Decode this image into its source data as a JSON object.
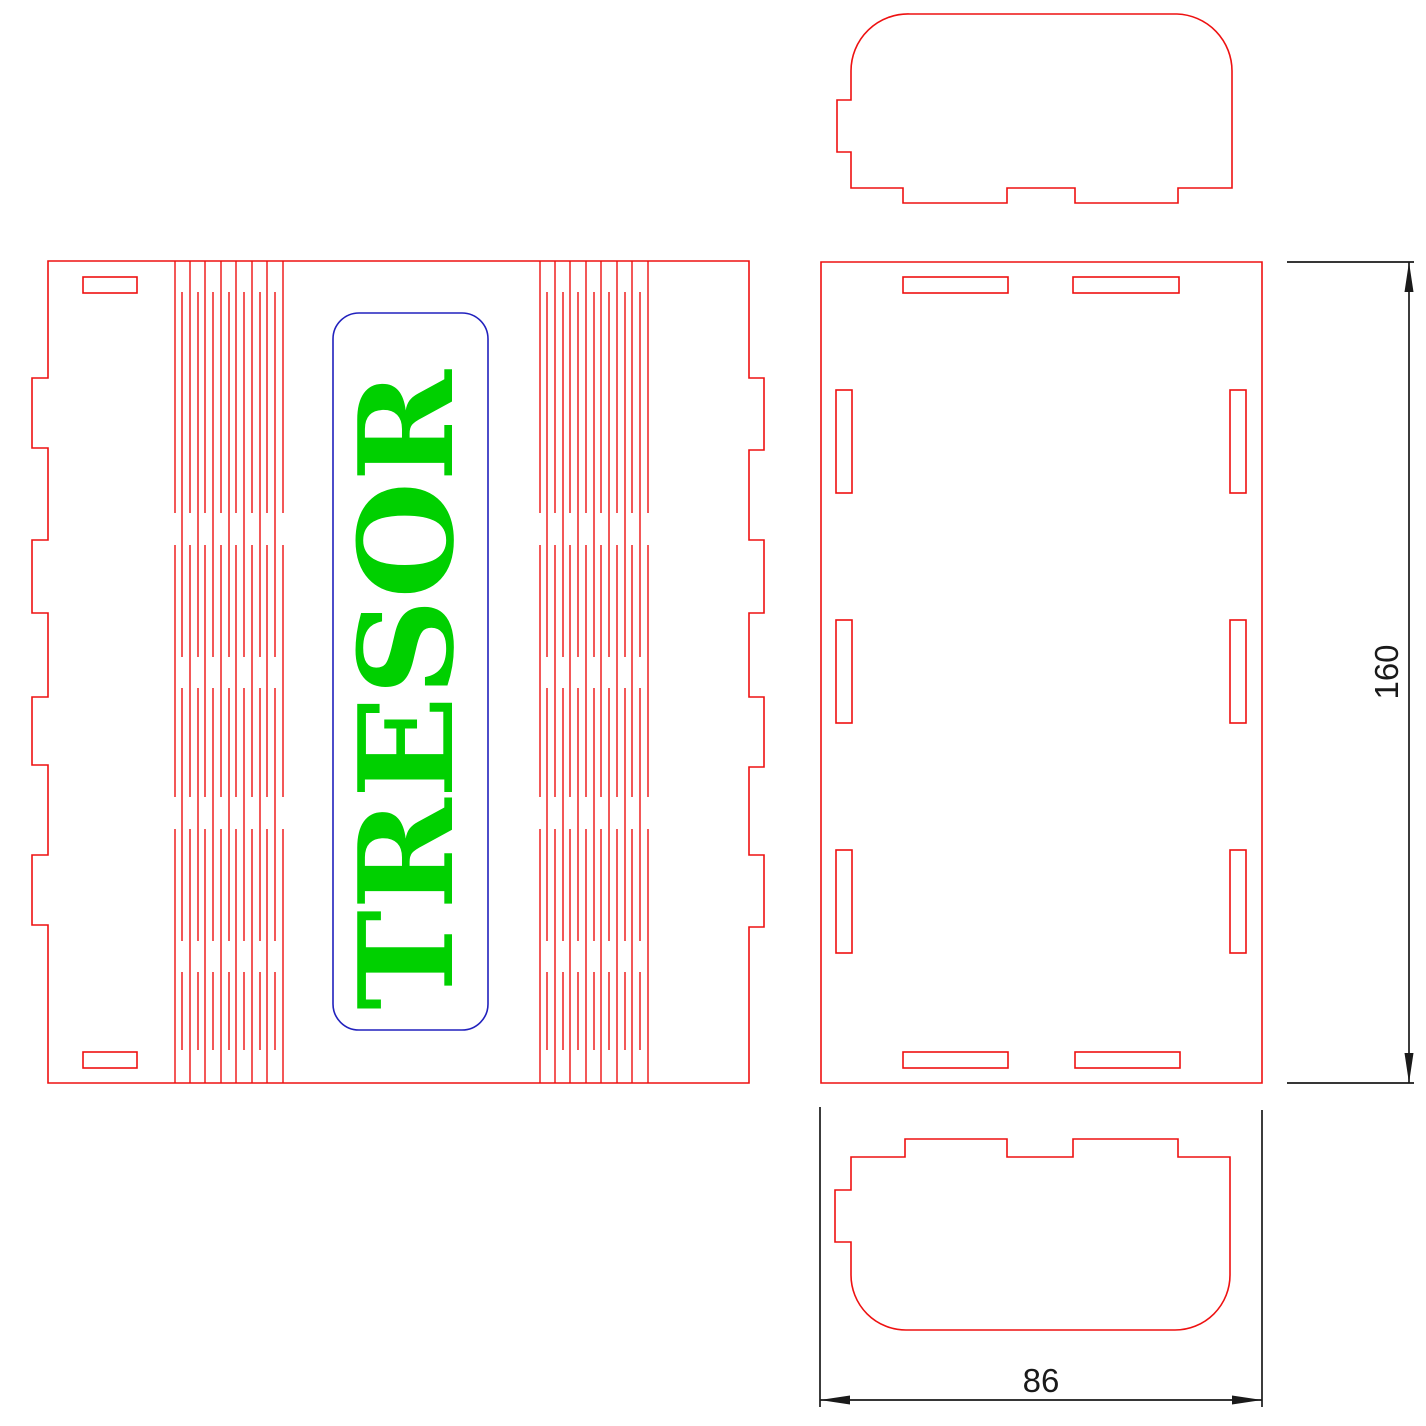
{
  "drawing": {
    "engraving_text": "TRESOR",
    "dimensions": {
      "height_label": "160",
      "width_label": "86"
    },
    "colors": {
      "cut_red": "#ee1111",
      "engrave_blue": "#2121bd",
      "engrave_green": "#00d000",
      "dimension_black": "#1a1a1a",
      "background": "#ffffff"
    },
    "living_hinge": {
      "long_segments": [
        [
          261,
          513
        ],
        [
          545,
          797
        ],
        [
          829,
          1083
        ]
      ],
      "short_segments": [
        [
          292,
          657
        ],
        [
          688,
          941
        ],
        [
          972,
          1050
        ]
      ],
      "groups": [
        {
          "long_xs": [
            175,
            190,
            205,
            221,
            236,
            252,
            267,
            283
          ],
          "short_xs": [
            182,
            198,
            213,
            229,
            244,
            260,
            275
          ]
        },
        {
          "long_xs": [
            540,
            555,
            570,
            586,
            601,
            617,
            632,
            648
          ],
          "short_xs": [
            547,
            563,
            578,
            594,
            609,
            625,
            640
          ]
        }
      ]
    }
  }
}
